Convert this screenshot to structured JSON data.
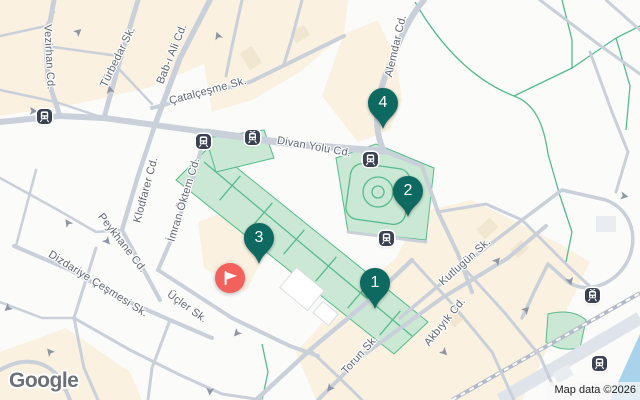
{
  "watermark": {
    "logo": "Google"
  },
  "attribution": {
    "text": "Map data ©2026"
  },
  "markers": [
    {
      "label": "1"
    },
    {
      "label": "2"
    },
    {
      "label": "3"
    },
    {
      "label": "4"
    }
  ],
  "flag_marker": {
    "icon": "flag-icon"
  },
  "streets": [
    {
      "name": "Vezirhan Cd."
    },
    {
      "name": "Türbedar Sk."
    },
    {
      "name": "Bab-ı Ali Cd."
    },
    {
      "name": "Çatalçeşme Sk."
    },
    {
      "name": "Divan Yolu Cd."
    },
    {
      "name": "Alemdar Cd."
    },
    {
      "name": "Klodfarer Cd."
    },
    {
      "name": "İmran Öktem Cd."
    },
    {
      "name": "Peykhane Cd."
    },
    {
      "name": "Dizdariye Çeşmesi Sk."
    },
    {
      "name": "Üçler Sk."
    },
    {
      "name": "Torun Sk."
    },
    {
      "name": "Akbıyık Cd."
    },
    {
      "name": "Kutlugün Sk."
    }
  ],
  "transit_stops": {
    "count": 7,
    "types": [
      "tram-stop",
      "tram-stop-pantograph"
    ]
  },
  "colors": {
    "marker_teal": "#0e6a61",
    "flag_red": "#f2615c",
    "park_green": "#cae8d3",
    "park_line_green": "#55bb8d",
    "water_blue": "#a9d3ea",
    "road_gray": "#c9d0da",
    "beige": "#faf1e0",
    "label_gray": "#5f6570",
    "transit_dark": "#3a4150"
  }
}
